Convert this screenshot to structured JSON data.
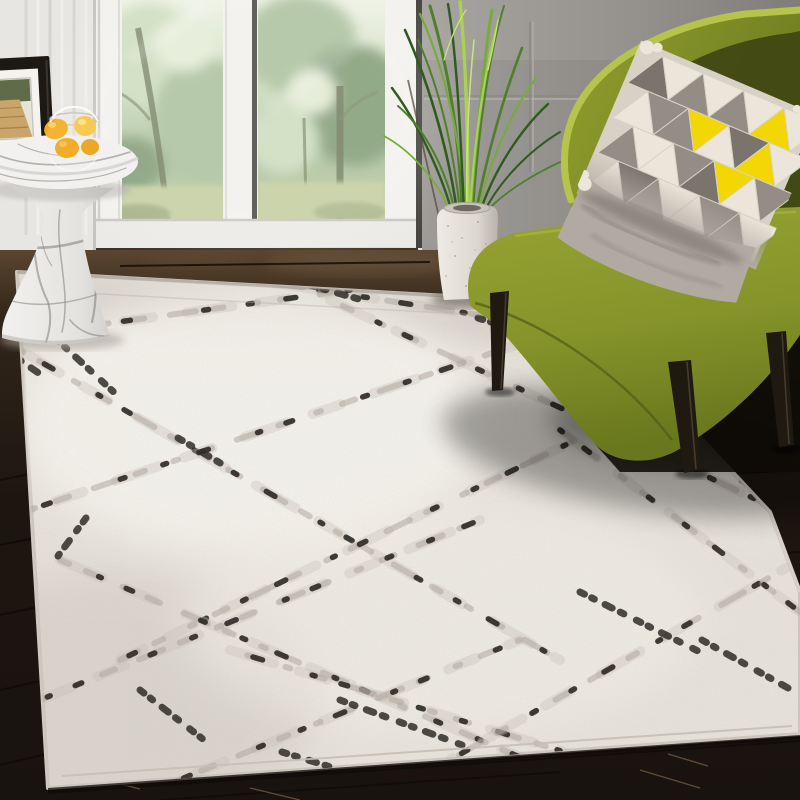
{
  "scene": {
    "description": "Sunlit living room corner: ivory distressed-trellis area rug, chartreuse accent chair with geometric triangle pillow, tall grass plant in a speckled white vase, round white-marble pedestal side table holding a glass bowl of lemons, black picture frame, white French doors with a green forest view, dark espresso plank floor",
    "objects": [
      {
        "name": "french-doors",
        "label": "white French doors with forest view"
      },
      {
        "name": "picture-frame",
        "label": "black frame with boardwalk photo"
      },
      {
        "name": "marble-side-table",
        "label": "round marble pedestal side table"
      },
      {
        "name": "fruit-bowl",
        "label": "glass bowl of lemons"
      },
      {
        "name": "grass-plant",
        "label": "tall artificial grass plant"
      },
      {
        "name": "white-vase",
        "label": "speckled white square vase"
      },
      {
        "name": "accent-chair",
        "label": "olive green armless slipper chair"
      },
      {
        "name": "triangle-pillow",
        "label": "gray / cream / yellow triangle pillow"
      },
      {
        "name": "area-rug",
        "label": "ivory rug with black distressed diamond lattice"
      },
      {
        "name": "wood-floor",
        "label": "dark espresso wood plank floor"
      }
    ]
  },
  "colors": {
    "wall_left": "#e8e6e3",
    "wall_left_shade": "#d3d1cd",
    "wall_right": "#a9a6a2",
    "wall_right_dark": "#807d79",
    "door_frame": "#f2f1ee",
    "door_frame_shade": "#d8d6d1",
    "door_gap_dark": "#514f4a",
    "window_sky": "#eef2e4",
    "window_green_light": "#cfdec0",
    "window_green": "#aec3a0",
    "window_green_dark": "#87a07b",
    "window_lawn": "#c6cfa3",
    "tree_trunk": "#757f61",
    "floor_top": "#5a4530",
    "floor_mid": "#32261a",
    "floor_dark": "#1d1610",
    "plank_seam": "#0f0b07",
    "plank_highlight": "#7d6347",
    "rug_ivory": "#e9e5dd",
    "rug_warm": "#f9f7f1",
    "rug_shade": "#cfc8bf",
    "rug_line_gray": "#b1a89e",
    "rug_line_soft": "#c9c1b7",
    "rug_speck": "#26221d",
    "rug_edge": "#d8d2c9",
    "marble_base": "#f2f1ef",
    "marble_shade": "#d0cecb",
    "marble_vein": "#7f7c78",
    "lemon": "#f3ab1b",
    "lemon_light": "#f8c63d",
    "glass_rim": "#c2c0bc",
    "frame_black": "#1c1813",
    "frame_mat": "#f4f3ef",
    "photo_trees": "#5f6b49",
    "photo_path": "#c9a56a",
    "photo_sky": "#e3e6d5",
    "vase_light": "#eeebe4",
    "vase_shade": "#b9b3aa",
    "vase_mouth": "#6e685f",
    "plant_dark": "#2f5a20",
    "plant_mid": "#4f7f2c",
    "plant_light": "#79ab3c",
    "plant_bright": "#a9d254",
    "plant_tip": "#c9e47a",
    "chair_rim": "#b7c44a",
    "chair_back": "#919e2d",
    "chair_back_dark": "#6b7a1f",
    "chair_inner": "#3f4513",
    "chair_seat": "#97a432",
    "chair_seat_front": "#69771e",
    "chair_piping": "#4f5c16",
    "leg_black": "#1f1912",
    "leg_highlight": "#463c2e",
    "pillow_base": "#d8d2c6",
    "pillow_gray": "#948d85",
    "pillow_gray_dark": "#7b746c",
    "pillow_cream": "#ece6da",
    "pillow_yellow": "#f2d705",
    "pillow_skirt": "#b1aaa2",
    "pillow_shadow": "#6e6760",
    "shadow": "#000000"
  }
}
